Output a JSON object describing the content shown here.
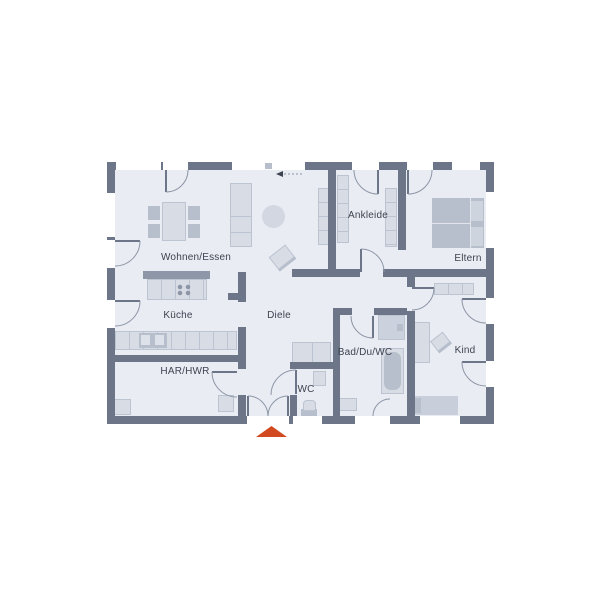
{
  "floorplan": {
    "rooms": [
      {
        "name": "wohnen-essen",
        "label": "Wohnen/Essen"
      },
      {
        "name": "kueche",
        "label": "Küche"
      },
      {
        "name": "har-hwr",
        "label": "HAR/HWR"
      },
      {
        "name": "diele",
        "label": "Diele"
      },
      {
        "name": "wc",
        "label": "WC"
      },
      {
        "name": "bad-du-wc",
        "label": "Bad/Du/WC"
      },
      {
        "name": "ankleide",
        "label": "Ankleide"
      },
      {
        "name": "eltern",
        "label": "Eltern"
      },
      {
        "name": "kind",
        "label": "Kind"
      }
    ],
    "markers": {
      "entrance_marker_icon": "triangle-up",
      "direction_arrow_icon": "arrow-left-dashed"
    },
    "colors": {
      "wall": "#6c7688",
      "floor": "#e9ecf2",
      "furniture": "#d7dce5",
      "furniture_border": "#bcc3d1",
      "furniture_dark": "#b7becc",
      "window_line": "#9aa3b2",
      "arc_line": "#8d96a6",
      "label_text": "#3d4350",
      "entrance_accent": "#d2491f"
    }
  }
}
